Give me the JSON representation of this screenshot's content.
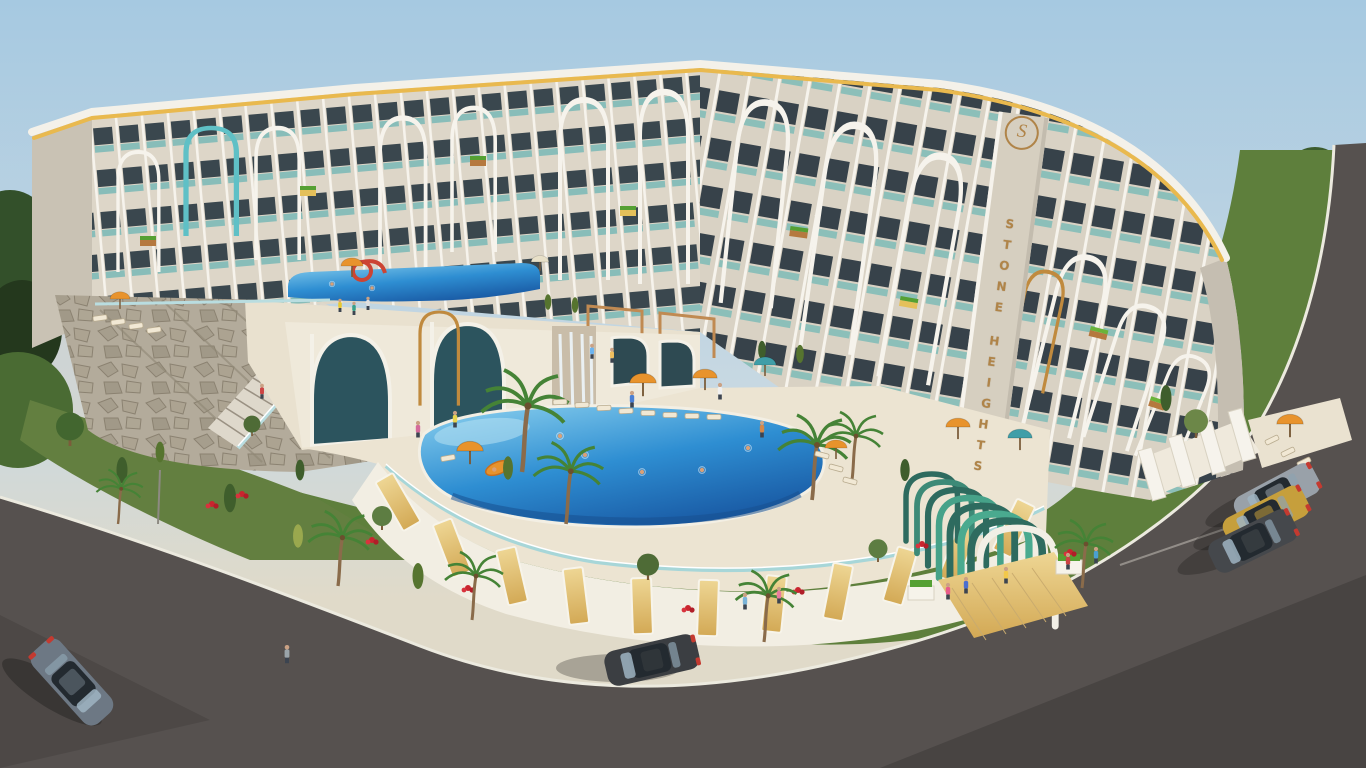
{
  "scene_type": "3D architectural rendering — aerial daytime view of a curved resort apartment complex with pools, gardens and roads",
  "branding": {
    "project_name": "STONE HEIGHTS",
    "sign_top": "STONE",
    "sign_bottom": "HEIGHTS",
    "logo_monogram": "S",
    "sign_color": "#b08448"
  },
  "palette": {
    "sky_top": "#a6c9e1",
    "sky_horizon": "#e0dac9",
    "facade_cream": "#ddd6c8",
    "facade_white": "#f6f3ec",
    "window_glass": "#37424a",
    "accent_teal": "#6fc0bd",
    "accent_gold": "#e9b94e",
    "wood": "#d8b05e",
    "stone_wall": "#b3ac9c",
    "pool_light": "#8ed2ef",
    "pool_deep": "#1a5ca6",
    "grass": "#5e7f3c",
    "asphalt": "#56514f",
    "entrance_green": "#2e6b5f"
  },
  "building": {
    "wings": 3,
    "floors_visible": "5-7",
    "features": [
      "tall white arched fins over recessed balconies",
      "teal glass balustrades",
      "wooden flower planters on balconies",
      "gold parapet band along the roofline",
      "vertical STONE HEIGHTS sign with round gold logo"
    ]
  },
  "amenities": [
    "large organic-shaped main pool with swimmers and an orange float",
    "upper terrace pool with red waterslide",
    "stone-clad podium with grand staircase",
    "rows of sun loungers",
    "orange and teal parasols",
    "palm trees, cypresses and red flower beds",
    "green arched entrance pergola with wooden deck",
    "arched spa facade with waterfall feature"
  ],
  "vehicles": [
    {
      "type": "suv",
      "color": "#6d7884",
      "position": "bottom-left road"
    },
    {
      "type": "sedan",
      "color": "#3b3e42",
      "position": "bottom-center road, parked at curb"
    },
    {
      "type": "estate-suv",
      "color": "#99a1a9",
      "position": "right parking row"
    },
    {
      "type": "sedan",
      "color": "#c69f3c",
      "position": "right parking row"
    },
    {
      "type": "sedan",
      "color": "#45484c",
      "position": "right parking row"
    }
  ]
}
